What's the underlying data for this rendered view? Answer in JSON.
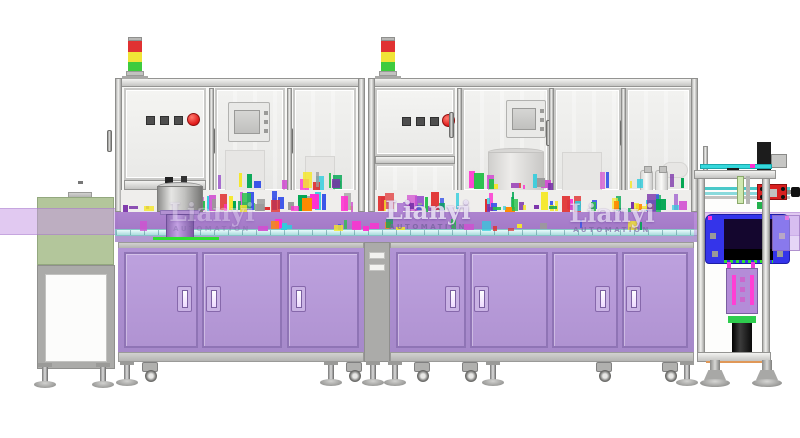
{
  "watermarks": [
    {
      "brand": "Lianyi",
      "subtitle": "AUTOMATION"
    },
    {
      "brand": "Lianyi",
      "subtitle": "AUTOMATION"
    },
    {
      "brand": "Lianyi",
      "subtitle": "AUTOMATION"
    }
  ],
  "colors": {
    "cabinet_body": "#b194d5",
    "cabinet_door": "#bda1de",
    "door_border": "#8f74b5",
    "table_band": "#a97dcd",
    "cyan_rail": "#aadcde",
    "band_translucent": "rgba(197,151,229,0.52)",
    "green_box": "#b3c69b",
    "frame_gray": "#ababa9",
    "stack_red": "#e03232",
    "stack_yellow": "#f0e437",
    "stack_green": "#3ecb3e",
    "estop_red": "#e01818",
    "housing_blue": "#3434ea",
    "accent_green": "#2ee02e",
    "watermark_text": "rgba(248,243,255,0.82)",
    "watermark_sub": "rgba(120,100,160,0.85)"
  },
  "machinery_palette": [
    "#9a55cc",
    "#d14fd1",
    "#ff2fd0",
    "#27c04a",
    "#00a651",
    "#2ecddd",
    "#f5e829",
    "#3b55e8",
    "#e03030",
    "#9a9a9a",
    "#ff8a00",
    "#7a33aa"
  ]
}
